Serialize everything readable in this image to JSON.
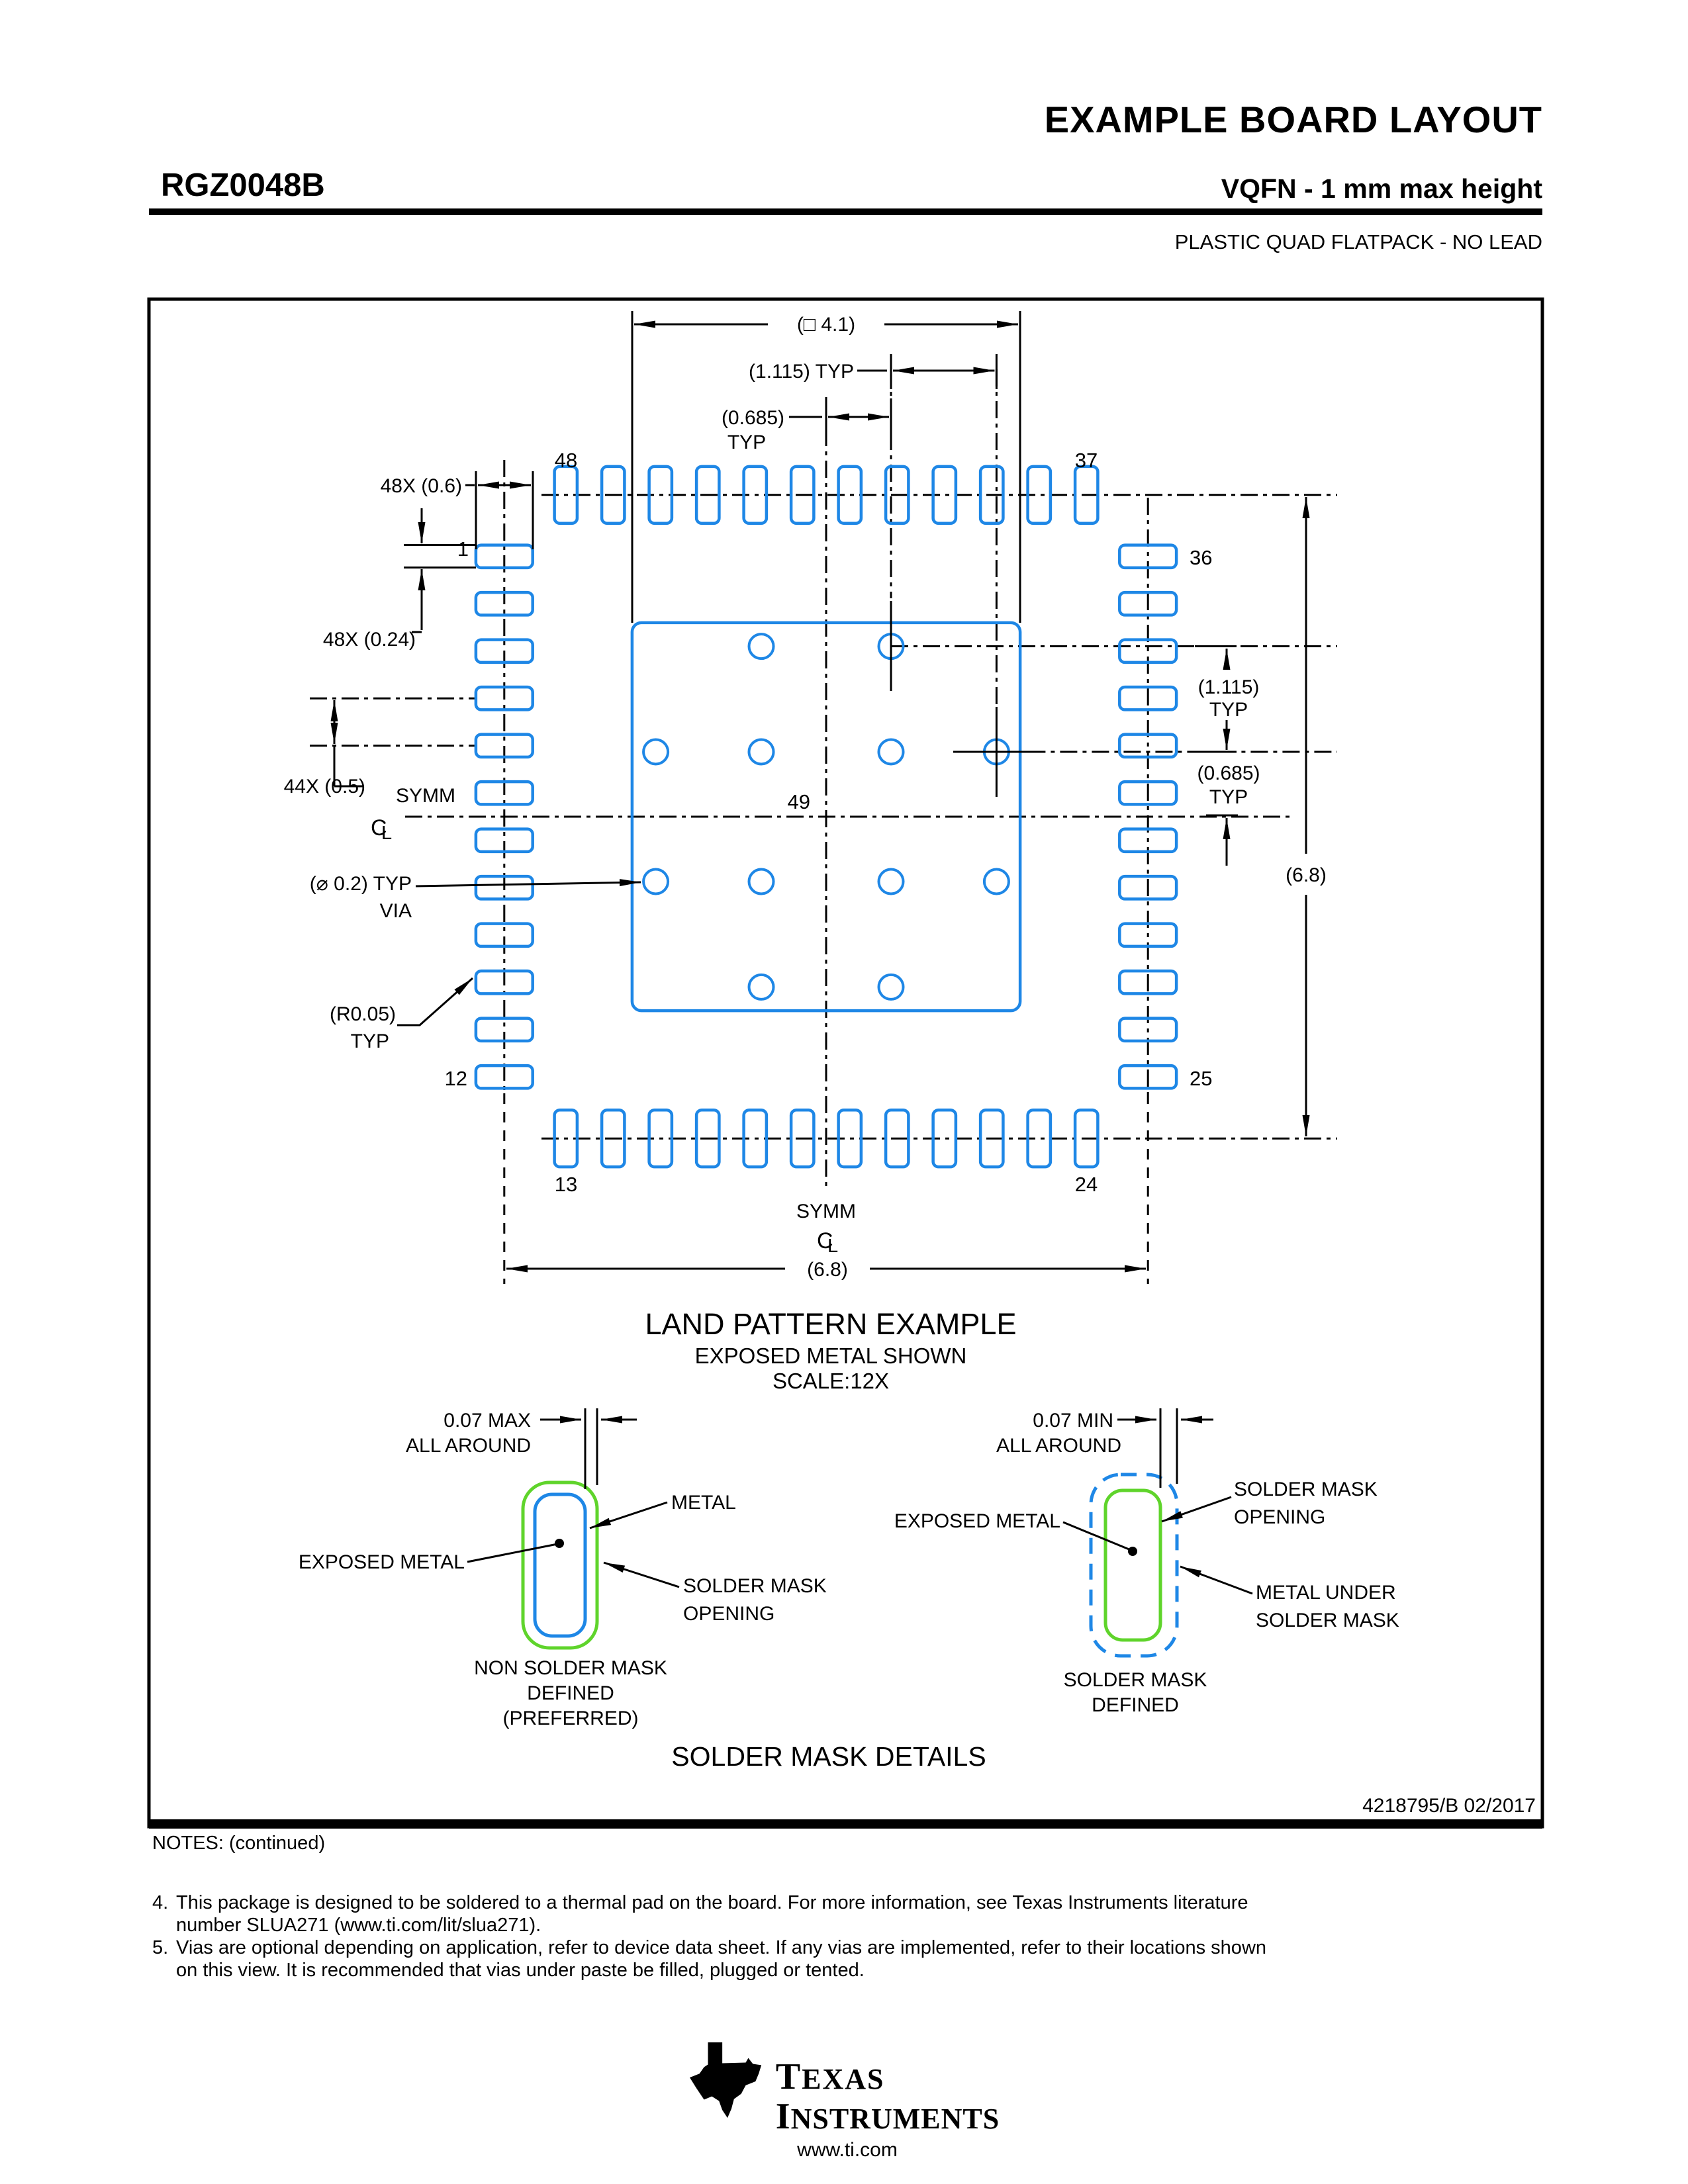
{
  "header": {
    "title": "EXAMPLE BOARD LAYOUT",
    "part_number": "RGZ0048B",
    "subtitle": "VQFN - 1 mm max height",
    "package_type": "PLASTIC QUAD FLATPACK - NO LEAD"
  },
  "drawing": {
    "dims": {
      "pad_square": "(□ 4.1)",
      "pitch_1115_typ": "(1.115) TYP",
      "d0685": "(0.685)",
      "d1115": "(1.115)",
      "typ": "TYP",
      "pads_len": "48X (0.6)",
      "pads_w": "48X (0.24)",
      "pitch": "44X (0.5)",
      "symm": "SYMM",
      "via_dia": "(⌀ 0.2) TYP",
      "via_word": "VIA",
      "radius": "(R0.05)",
      "span": "(6.8)"
    },
    "pins": {
      "p1": "1",
      "p12": "12",
      "p13": "13",
      "p24": "24",
      "p25": "25",
      "p36": "36",
      "p37": "37",
      "p48": "48",
      "p49": "49"
    },
    "captions": {
      "title": "LAND PATTERN EXAMPLE",
      "sub1": "EXPOSED METAL SHOWN",
      "sub2": "SCALE:12X"
    }
  },
  "details": {
    "left": {
      "gap": "0.07 MAX",
      "all_around": "ALL AROUND",
      "metal": "METAL",
      "exposed": "EXPOSED METAL",
      "smo1": "SOLDER MASK",
      "smo2": "OPENING",
      "cap1": "NON SOLDER MASK",
      "cap2": "DEFINED",
      "cap3": "(PREFERRED)"
    },
    "right": {
      "gap": "0.07 MIN",
      "all_around": "ALL AROUND",
      "smo1": "SOLDER MASK",
      "smo2": "OPENING",
      "exposed": "EXPOSED METAL",
      "mus1": "METAL UNDER",
      "mus2": "SOLDER MASK",
      "cap1": "SOLDER MASK",
      "cap2": "DEFINED"
    },
    "title": "SOLDER MASK DETAILS"
  },
  "footer": {
    "doc_number": "4218795/B   02/2017"
  },
  "notes": {
    "heading": "NOTES: (continued)",
    "items": [
      {
        "num": "4.",
        "lines": [
          "This package is designed to be soldered to a thermal pad on the board. For more information, see Texas Instruments literature",
          "number SLUA271 (www.ti.com/lit/slua271)."
        ]
      },
      {
        "num": "5.",
        "lines": [
          "Vias are optional depending on application, refer to device data sheet. If any vias are implemented, refer to their locations shown",
          "on this view. It is recommended that vias under paste be filled, plugged or tented."
        ]
      }
    ]
  },
  "brand": {
    "name1": "TEXAS",
    "name2": "INSTRUMENTS",
    "url": "www.ti.com"
  },
  "colors": {
    "pad_blue": "#1E87E6",
    "mask_green": "#5FD42B"
  }
}
